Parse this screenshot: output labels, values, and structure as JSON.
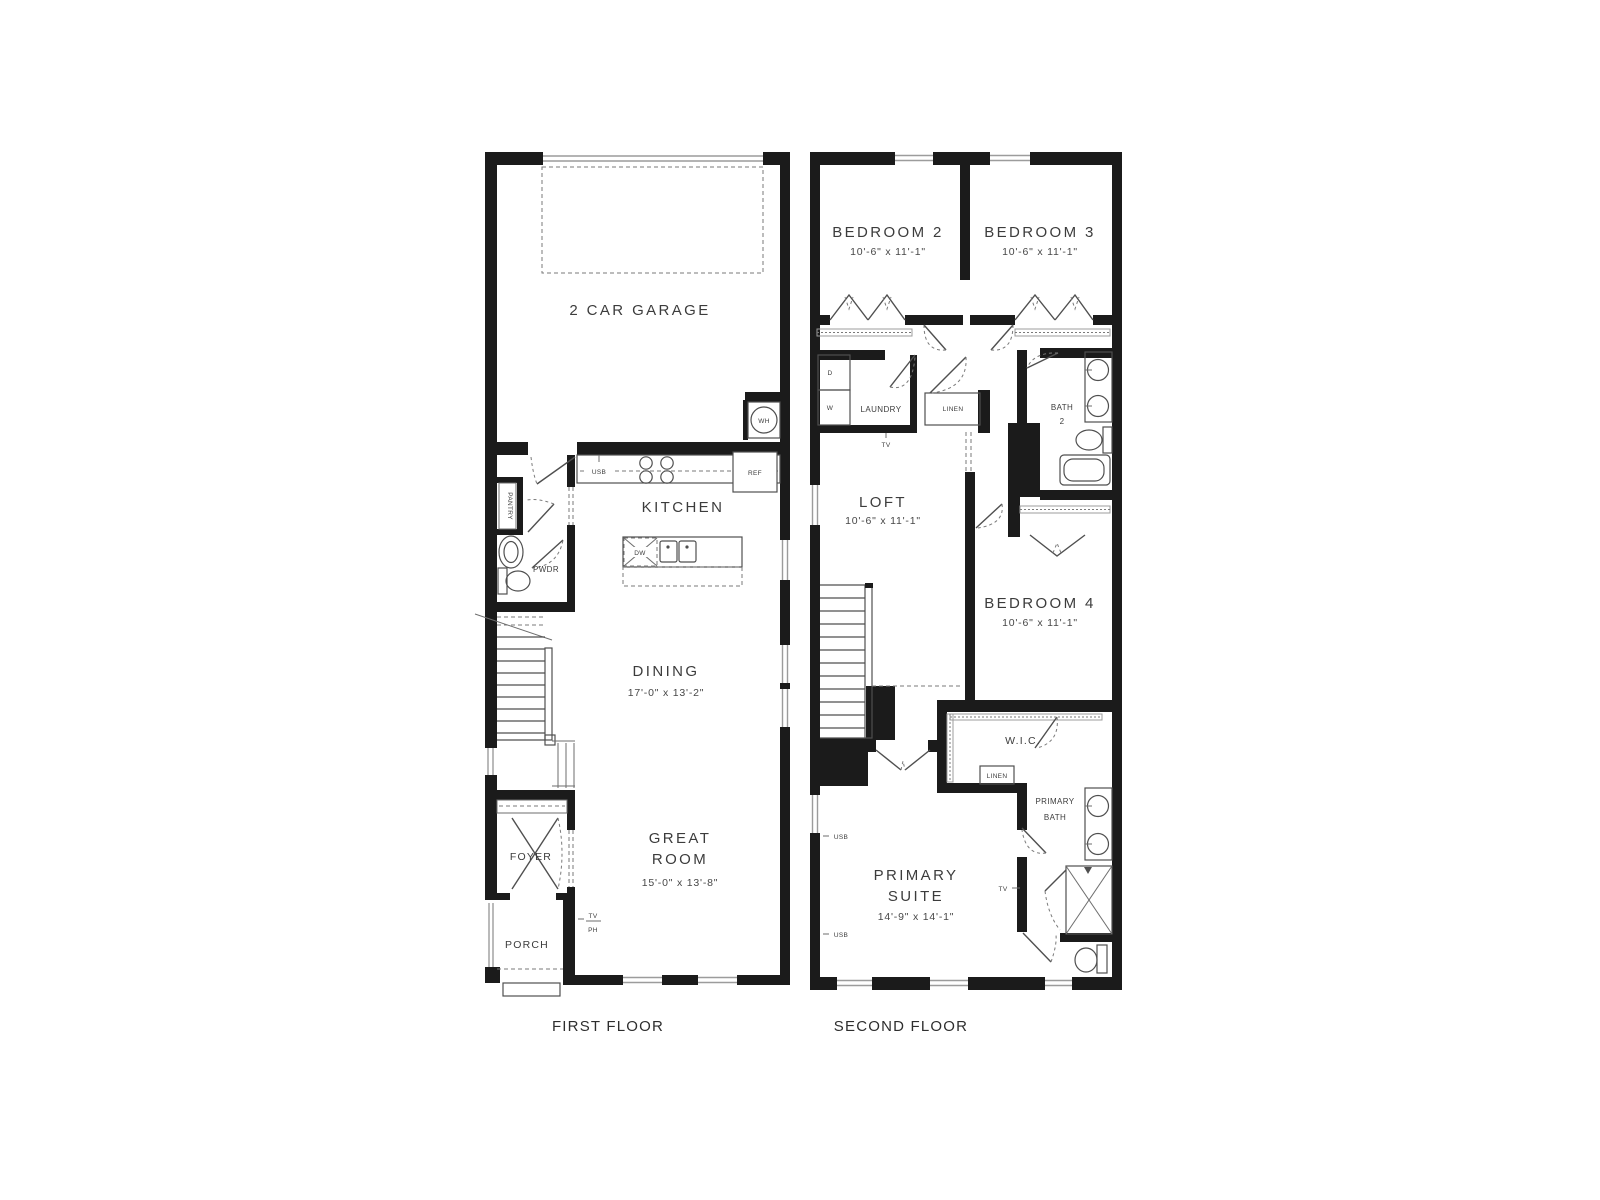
{
  "captions": {
    "first": "FIRST FLOOR",
    "second": "SECOND FLOOR"
  },
  "first_floor": {
    "garage_label": "2 CAR GARAGE",
    "wh": "WH",
    "usb": "USB",
    "ref": "REF",
    "kitchen_label": "KITCHEN",
    "dw": "DW",
    "pantry_label": "PANTRY",
    "pwdr_label": "PWDR",
    "dining_label": "DINING",
    "dining_dims": "17'-0\" x 13'-2\"",
    "great_line1": "GREAT",
    "great_line2": "ROOM",
    "great_dims": "15'-0\" x 13'-8\"",
    "foyer_label": "FOYER",
    "porch_label": "PORCH",
    "tv": "TV",
    "ph": "PH"
  },
  "second_floor": {
    "bedroom2_label": "BEDROOM 2",
    "bedroom2_dims": "10'-6\" x 11'-1\"",
    "bedroom3_label": "BEDROOM 3",
    "bedroom3_dims": "10'-6\" x 11'-1\"",
    "dryer": "D",
    "washer": "W",
    "laundry_label": "LAUNDRY",
    "laundry_tv": "TV",
    "linen_hall": "LINEN",
    "bath2_line1": "BATH",
    "bath2_line2": "2",
    "loft_label": "LOFT",
    "loft_dims": "10'-6\" x 11'-1\"",
    "bedroom4_label": "BEDROOM 4",
    "bedroom4_dims": "10'-6\" x 11'-1\"",
    "wic_label": "W.I.C.",
    "linen_wic": "LINEN",
    "primary_bath_line1": "PRIMARY",
    "primary_bath_line2": "BATH",
    "tv_label": "TV",
    "usb_upper": "USB",
    "usb_lower": "USB",
    "primary_suite_line1": "PRIMARY",
    "primary_suite_line2": "SUITE",
    "primary_suite_dims": "14'-9\" x 14'-1\""
  }
}
